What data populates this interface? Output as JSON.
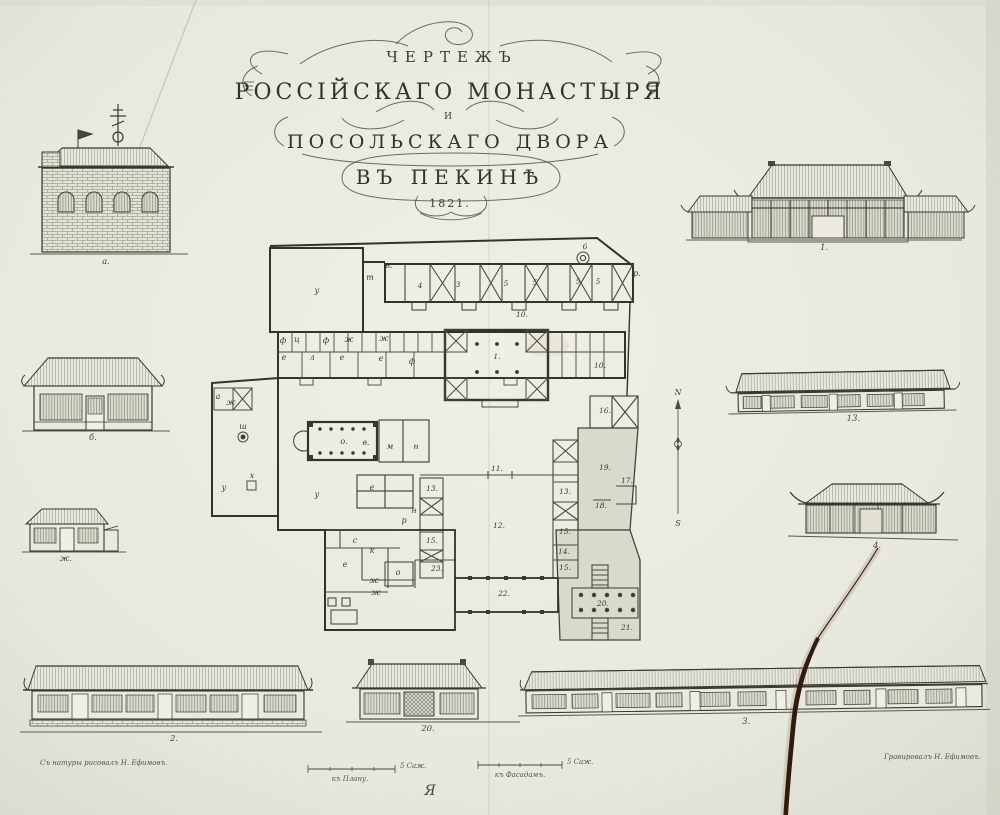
{
  "title": {
    "line1": "ЧЕРТЕЖЪ",
    "line2": "РОССІЙСКАГО  МОНАСТЫРЯ",
    "line3": "И",
    "line4": "ПОСОЛЬСКАГО  ДВОРА",
    "line5": "ВЪ  ПЕКИНѢ",
    "year": "1821."
  },
  "elevation_labels": {
    "church": "а.",
    "house": "б.",
    "shed": "ж.",
    "pavilion_main": "1.",
    "long_east": "13.",
    "pavilion_east": "4.",
    "long_southwest": "2.",
    "pavilion_south": "20.",
    "long_south": "3."
  },
  "compass": {
    "north": "N",
    "south": "S"
  },
  "scale_bars": {
    "plan_unit": "5 Саж.",
    "plan_caption": "къ Плану.",
    "facade_unit": "5 Саж.",
    "facade_caption": "къ Фасадамъ."
  },
  "credits": {
    "left": "Съ натуры рисовалъ Н. Ефимовъ.",
    "right": "Гравировалъ Н. Ефимовъ."
  },
  "printer_mark": "Я",
  "plan_labels": [
    {
      "t": "6",
      "x": 585,
      "y": 249,
      "k": "num"
    },
    {
      "t": "4",
      "x": 420,
      "y": 288,
      "k": "num"
    },
    {
      "t": "3",
      "x": 458,
      "y": 287,
      "k": "num"
    },
    {
      "t": "5",
      "x": 506,
      "y": 286,
      "k": "num"
    },
    {
      "t": "5",
      "x": 535,
      "y": 285,
      "k": "num"
    },
    {
      "t": "5",
      "x": 578,
      "y": 284,
      "k": "num"
    },
    {
      "t": "5",
      "x": 598,
      "y": 284,
      "k": "num"
    },
    {
      "t": "10.",
      "x": 522,
      "y": 317,
      "k": "num"
    },
    {
      "t": "10.",
      "x": 600,
      "y": 368,
      "k": "num"
    },
    {
      "t": "1.",
      "x": 497,
      "y": 359,
      "k": "num"
    },
    {
      "t": "16.",
      "x": 605,
      "y": 413,
      "k": "num"
    },
    {
      "t": "11.",
      "x": 497,
      "y": 471,
      "k": "num"
    },
    {
      "t": "19.",
      "x": 605,
      "y": 470,
      "k": "num"
    },
    {
      "t": "17.",
      "x": 627,
      "y": 483,
      "k": "num"
    },
    {
      "t": "18.",
      "x": 601,
      "y": 508,
      "k": "num"
    },
    {
      "t": "13.",
      "x": 565,
      "y": 494,
      "k": "num"
    },
    {
      "t": "15.",
      "x": 565,
      "y": 534,
      "k": "num"
    },
    {
      "t": "14.",
      "x": 564,
      "y": 554,
      "k": "num"
    },
    {
      "t": "15.",
      "x": 565,
      "y": 570,
      "k": "num"
    },
    {
      "t": "13.",
      "x": 432,
      "y": 491,
      "k": "num"
    },
    {
      "t": "15.",
      "x": 432,
      "y": 543,
      "k": "num"
    },
    {
      "t": "23.",
      "x": 437,
      "y": 571,
      "k": "num"
    },
    {
      "t": "12.",
      "x": 499,
      "y": 528,
      "k": "num"
    },
    {
      "t": "22.",
      "x": 504,
      "y": 596,
      "k": "num"
    },
    {
      "t": "20.",
      "x": 603,
      "y": 606,
      "k": "num"
    },
    {
      "t": "21.",
      "x": 627,
      "y": 630,
      "k": "num"
    },
    {
      "t": "р.",
      "x": 637,
      "y": 276,
      "k": "let"
    },
    {
      "t": "у",
      "x": 317,
      "y": 293,
      "k": "let"
    },
    {
      "t": "в.",
      "x": 389,
      "y": 268,
      "k": "let"
    },
    {
      "t": "т",
      "x": 370,
      "y": 280,
      "k": "let"
    },
    {
      "t": "ф",
      "x": 283,
      "y": 343,
      "k": "let"
    },
    {
      "t": "ц",
      "x": 297,
      "y": 342,
      "k": "let"
    },
    {
      "t": "ф",
      "x": 326,
      "y": 343,
      "k": "let"
    },
    {
      "t": "ж",
      "x": 349,
      "y": 342,
      "k": "let"
    },
    {
      "t": "ж",
      "x": 384,
      "y": 341,
      "k": "let"
    },
    {
      "t": "е",
      "x": 284,
      "y": 360,
      "k": "let"
    },
    {
      "t": "л",
      "x": 312,
      "y": 360,
      "k": "let"
    },
    {
      "t": "е",
      "x": 342,
      "y": 360,
      "k": "let"
    },
    {
      "t": "е",
      "x": 381,
      "y": 361,
      "k": "let"
    },
    {
      "t": "ф",
      "x": 412,
      "y": 364,
      "k": "let"
    },
    {
      "t": "а",
      "x": 218,
      "y": 399,
      "k": "let"
    },
    {
      "t": "ж",
      "x": 231,
      "y": 405,
      "k": "let"
    },
    {
      "t": "ш",
      "x": 243,
      "y": 429,
      "k": "let"
    },
    {
      "t": "х",
      "x": 252,
      "y": 478,
      "k": "let"
    },
    {
      "t": "у",
      "x": 224,
      "y": 490,
      "k": "let"
    },
    {
      "t": "у",
      "x": 317,
      "y": 497,
      "k": "let"
    },
    {
      "t": "о.",
      "x": 344,
      "y": 444,
      "k": "let"
    },
    {
      "t": "ѳ.",
      "x": 366,
      "y": 445,
      "k": "let"
    },
    {
      "t": "м",
      "x": 390,
      "y": 449,
      "k": "let"
    },
    {
      "t": "н",
      "x": 416,
      "y": 449,
      "k": "let"
    },
    {
      "t": "е",
      "x": 372,
      "y": 490,
      "k": "let"
    },
    {
      "t": "н",
      "x": 414,
      "y": 513,
      "k": "let"
    },
    {
      "t": "р",
      "x": 404,
      "y": 523,
      "k": "let"
    },
    {
      "t": "с",
      "x": 355,
      "y": 543,
      "k": "let"
    },
    {
      "t": "е",
      "x": 345,
      "y": 567,
      "k": "let"
    },
    {
      "t": "к",
      "x": 372,
      "y": 553,
      "k": "let"
    },
    {
      "t": "о",
      "x": 398,
      "y": 575,
      "k": "let"
    },
    {
      "t": "ж",
      "x": 374,
      "y": 583,
      "k": "let"
    },
    {
      "t": "ж",
      "x": 376,
      "y": 595,
      "k": "let"
    }
  ]
}
